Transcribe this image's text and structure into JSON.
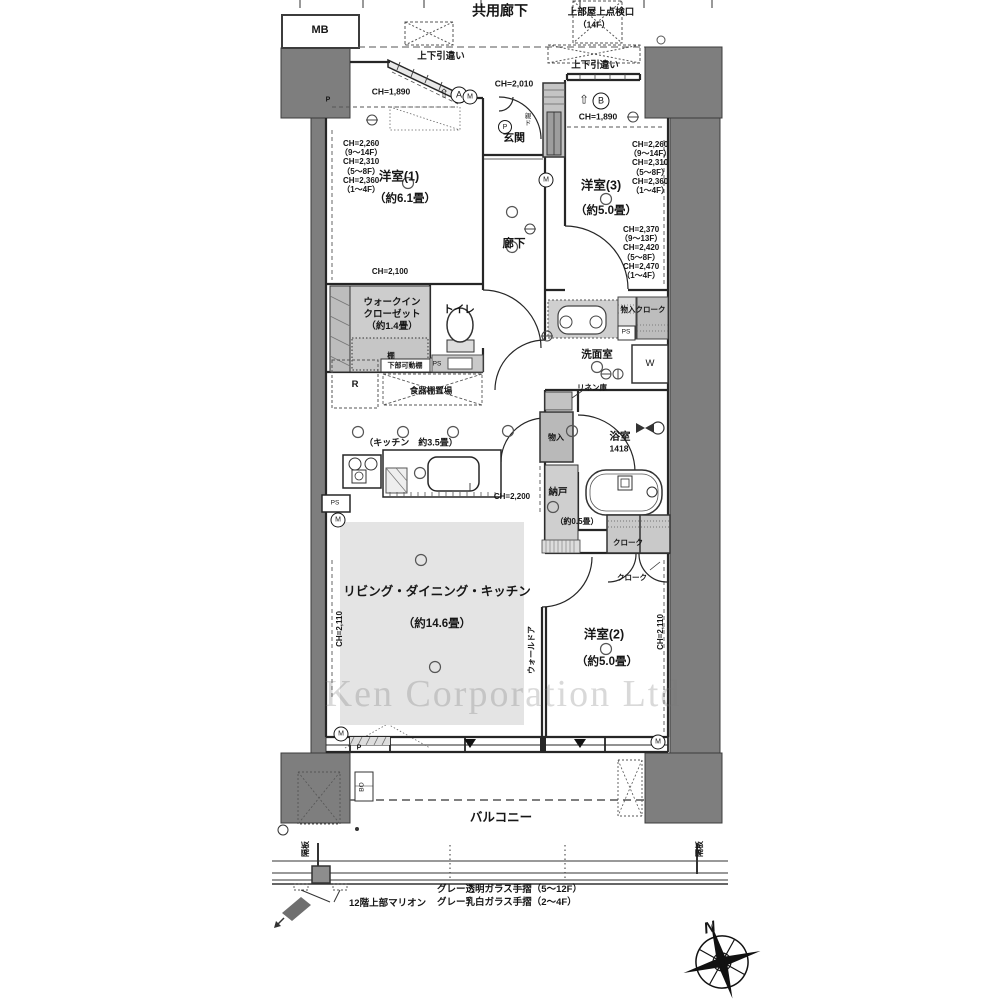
{
  "doc_type": "floor-plan",
  "watermark_text": "Ken Corporation Ltd",
  "colors": {
    "wall_fill": "#7e7e7e",
    "fixture_gray": "#c9c9c9",
    "ldk_floor": "#e4e4e4",
    "line": "#262626"
  },
  "annotations": [
    {
      "n": "corridor-title",
      "t": "共用廊下",
      "x": 500,
      "y": 11,
      "s": 14,
      "b": 1
    },
    {
      "n": "roof-access-label",
      "t": "上部屋上点検口",
      "x": 601,
      "y": 13,
      "s": 9.5,
      "b": 1
    },
    {
      "n": "roof-access-floor",
      "t": "（14F）",
      "x": 594,
      "y": 25,
      "s": 8.5,
      "b": 1
    },
    {
      "n": "mb-label",
      "t": "MB",
      "x": 320,
      "y": 31,
      "s": 11,
      "b": 1
    },
    {
      "n": "sliding-window-label-left",
      "t": "上下引違い",
      "x": 441,
      "y": 57,
      "s": 9.5,
      "b": 1
    },
    {
      "n": "sliding-window-label-right",
      "t": "上下引違い",
      "x": 595,
      "y": 66,
      "s": 9.5,
      "b": 1
    },
    {
      "n": "ch-1890-left",
      "t": "CH=1,890",
      "x": 391,
      "y": 92,
      "s": 8.5,
      "b": 1
    },
    {
      "n": "arrow-a-icon",
      "t": "⇧",
      "x": 444,
      "y": 94,
      "s": 12
    },
    {
      "n": "mark-a",
      "t": "A",
      "x": 459,
      "y": 95,
      "s": 9,
      "circ": 15
    },
    {
      "n": "ch-2010",
      "t": "CH=2,010",
      "x": 514,
      "y": 84,
      "s": 8.5,
      "b": 1
    },
    {
      "n": "arrow-b-icon",
      "t": "⇧",
      "x": 584,
      "y": 100,
      "s": 12
    },
    {
      "n": "mark-b",
      "t": "B",
      "x": 601,
      "y": 101,
      "s": 9,
      "circ": 15
    },
    {
      "n": "ch-1890-right",
      "t": "CH=1,890",
      "x": 598,
      "y": 117,
      "s": 8.5,
      "b": 1
    },
    {
      "n": "entrance-label",
      "t": "玄関",
      "x": 514,
      "y": 139,
      "s": 11,
      "b": 1
    },
    {
      "n": "entrance-p-mark",
      "t": "P",
      "x": 505,
      "y": 127,
      "s": 7,
      "circ": 12
    },
    {
      "n": "entrance-door-label",
      "t": "親\nド",
      "x": 528,
      "y": 120,
      "s": 6.5,
      "pre": 1,
      "lh": 7
    },
    {
      "n": "room1-label",
      "t": "洋室(1)",
      "x": 399,
      "y": 177,
      "s": 12.5,
      "b": 1
    },
    {
      "n": "room1-size",
      "t": "（約6.1畳）",
      "x": 405,
      "y": 199,
      "s": 11.5,
      "b": 1
    },
    {
      "n": "room1-ch-heights",
      "t": "CH=2,260\n（9～14F）\nCH=2,310\n（5～8F）\nCH=2,360\n（1～4F）",
      "x": 340,
      "y": 139,
      "s": 8,
      "b": 1,
      "pre": 1,
      "lh": 9.2,
      "align": "tl"
    },
    {
      "n": "room3-label",
      "t": "洋室(3)",
      "x": 601,
      "y": 186,
      "s": 12.5,
      "b": 1
    },
    {
      "n": "room3-size",
      "t": "（約5.0畳）",
      "x": 606,
      "y": 211,
      "s": 11.5,
      "b": 1
    },
    {
      "n": "room3-ch-heights-upper",
      "t": "CH=2,260\n（9～14F）\nCH=2,310\n（5～8F）\nCH=2,360\n（1～4F）",
      "x": 629,
      "y": 140,
      "s": 8,
      "b": 1,
      "pre": 1,
      "lh": 9.2,
      "align": "tl"
    },
    {
      "n": "room3-ch-heights-lower",
      "t": "CH=2,370\n（9～13F）\nCH=2,420\n（5～8F）\nCH=2,470\n（1～4F）",
      "x": 620,
      "y": 225,
      "s": 8,
      "b": 1,
      "pre": 1,
      "lh": 9.2,
      "align": "tl"
    },
    {
      "n": "hallway-label",
      "t": "廊下",
      "x": 514,
      "y": 244,
      "s": 11.5,
      "b": 1
    },
    {
      "n": "ch-2100",
      "t": "CH=2,100",
      "x": 390,
      "y": 272,
      "s": 8,
      "b": 1
    },
    {
      "n": "wic-label",
      "t": "ウォークイン\nクローゼット\n（約1.4畳）",
      "x": 392,
      "y": 315,
      "s": 9.5,
      "b": 1,
      "pre": 1,
      "lh": 12
    },
    {
      "n": "shelf-label",
      "t": "棚",
      "x": 391,
      "y": 356,
      "s": 7.5,
      "b": 1
    },
    {
      "n": "lower-movable-shelf-label",
      "t": "下部可動棚",
      "x": 405,
      "y": 366,
      "s": 7,
      "b": 1
    },
    {
      "n": "ps-wic",
      "t": "PS",
      "x": 437,
      "y": 365,
      "s": 6.5
    },
    {
      "n": "toilet-label",
      "t": "トイレ",
      "x": 459,
      "y": 310,
      "s": 10.5,
      "b": 1
    },
    {
      "n": "fridge-label",
      "t": "R",
      "x": 355,
      "y": 385,
      "s": 9.5,
      "b": 1
    },
    {
      "n": "cupboard-space-label",
      "t": "食器棚置場",
      "x": 431,
      "y": 391,
      "s": 8.5,
      "b": 1
    },
    {
      "n": "storage-cloak-label",
      "t": "物入クローク",
      "x": 643,
      "y": 310,
      "s": 7.5,
      "b": 1
    },
    {
      "n": "ps-washroom",
      "t": "PS",
      "x": 626,
      "y": 333,
      "s": 6.5
    },
    {
      "n": "washroom-label",
      "t": "洗面室",
      "x": 597,
      "y": 355,
      "s": 10.5,
      "b": 1
    },
    {
      "n": "washer-label",
      "t": "W",
      "x": 650,
      "y": 364,
      "s": 9.5
    },
    {
      "n": "linen-label",
      "t": "リネン庫",
      "x": 592,
      "y": 388,
      "s": 7.5,
      "b": 1
    },
    {
      "n": "hall-storage-label",
      "t": "物入",
      "x": 556,
      "y": 438,
      "s": 8,
      "b": 1
    },
    {
      "n": "bath-label",
      "t": "浴室",
      "x": 620,
      "y": 437,
      "s": 10.5,
      "b": 1
    },
    {
      "n": "bath-size",
      "t": "1418",
      "x": 619,
      "y": 449,
      "s": 8.5,
      "b": 1
    },
    {
      "n": "kitchen-label",
      "t": "（キッチン　約3.5畳）",
      "x": 411,
      "y": 443,
      "s": 9,
      "b": 1
    },
    {
      "n": "ch-2200",
      "t": "CH=2,200",
      "x": 512,
      "y": 497,
      "s": 8,
      "b": 1
    },
    {
      "n": "nando-label",
      "t": "納戸",
      "x": 558,
      "y": 493,
      "s": 9.5,
      "b": 1
    },
    {
      "n": "nando-size",
      "t": "（約0.5畳）",
      "x": 577,
      "y": 522,
      "s": 8,
      "b": 1
    },
    {
      "n": "ps-kitchen",
      "t": "PS",
      "x": 335,
      "y": 504,
      "s": 6.5
    },
    {
      "n": "cloak-label-1",
      "t": "クローク",
      "x": 628,
      "y": 543,
      "s": 7.5,
      "b": 1
    },
    {
      "n": "cloak-label-2",
      "t": "クローク",
      "x": 632,
      "y": 578,
      "s": 7.5,
      "b": 1
    },
    {
      "n": "ldk-label",
      "t": "リビング・ダイニング・キッチン",
      "x": 437,
      "y": 592,
      "s": 12.5,
      "b": 1
    },
    {
      "n": "ldk-size",
      "t": "（約14.6畳）",
      "x": 437,
      "y": 624,
      "s": 11.5,
      "b": 1
    },
    {
      "n": "ch-2110-left",
      "t": "CH=2,110",
      "x": 340,
      "y": 629,
      "s": 8,
      "b": 1,
      "v": 1
    },
    {
      "n": "wall-door-label",
      "t": "ウォールドア",
      "x": 532,
      "y": 650,
      "s": 8,
      "b": 1,
      "v": 1
    },
    {
      "n": "room2-label",
      "t": "洋室(2)",
      "x": 604,
      "y": 635,
      "s": 12.5,
      "b": 1
    },
    {
      "n": "room2-size",
      "t": "（約5.0畳）",
      "x": 607,
      "y": 662,
      "s": 11.5,
      "b": 1
    },
    {
      "n": "ch-2110-right",
      "t": "CH=2,110",
      "x": 661,
      "y": 632,
      "s": 8,
      "b": 1,
      "v": 1
    },
    {
      "n": "balcony-label",
      "t": "バルコニー",
      "x": 501,
      "y": 818,
      "s": 12.5,
      "b": 1
    },
    {
      "n": "bo-label",
      "t": "BO",
      "x": 363,
      "y": 787,
      "s": 6.5,
      "v": 1
    },
    {
      "n": "partition-label-left",
      "t": "隔板",
      "x": 306,
      "y": 849,
      "s": 8,
      "b": 1,
      "v": 1
    },
    {
      "n": "partition-label-right",
      "t": "隔板",
      "x": 700,
      "y": 849,
      "s": 8,
      "b": 1,
      "v": 1
    },
    {
      "n": "mullion-label",
      "t": "12階上部マリオン",
      "x": 349,
      "y": 904,
      "s": 9.5,
      "b": 1,
      "align": "l"
    },
    {
      "n": "glass-rail-label-1",
      "t": "グレー透明ガラス手摺（5～12F）",
      "x": 437,
      "y": 890,
      "s": 9.5,
      "b": 1,
      "align": "l"
    },
    {
      "n": "glass-rail-label-2",
      "t": "グレー乳白ガラス手摺（2～4F）",
      "x": 437,
      "y": 903,
      "s": 9.5,
      "b": 1,
      "align": "l"
    },
    {
      "n": "compass-n-label",
      "t": "N",
      "x": 710,
      "y": 929,
      "s": 16,
      "b": 1,
      "i": 1,
      "rot": -14
    },
    {
      "n": "p-mark-top-left",
      "t": "P",
      "x": 328,
      "y": 100,
      "s": 7,
      "b": 1
    },
    {
      "n": "p-mark-bottom",
      "t": "P",
      "x": 359,
      "y": 748,
      "s": 7,
      "b": 1
    },
    {
      "n": "meter-mark-1",
      "t": "M",
      "x": 470,
      "y": 97,
      "s": 7,
      "circ": 13
    },
    {
      "n": "meter-mark-2",
      "t": "M",
      "x": 546,
      "y": 180,
      "s": 7,
      "circ": 13
    },
    {
      "n": "meter-mark-3",
      "t": "M",
      "x": 338,
      "y": 520,
      "s": 7,
      "circ": 13
    },
    {
      "n": "meter-mark-4",
      "t": "M",
      "x": 341,
      "y": 734,
      "s": 7,
      "circ": 13
    },
    {
      "n": "meter-mark-5",
      "t": "M",
      "x": 658,
      "y": 742,
      "s": 7,
      "circ": 13
    },
    {
      "n": "watermark",
      "t": "Ken Corporation Ltd",
      "x": 503,
      "y": 695,
      "s": 38,
      "wm": 1
    }
  ]
}
